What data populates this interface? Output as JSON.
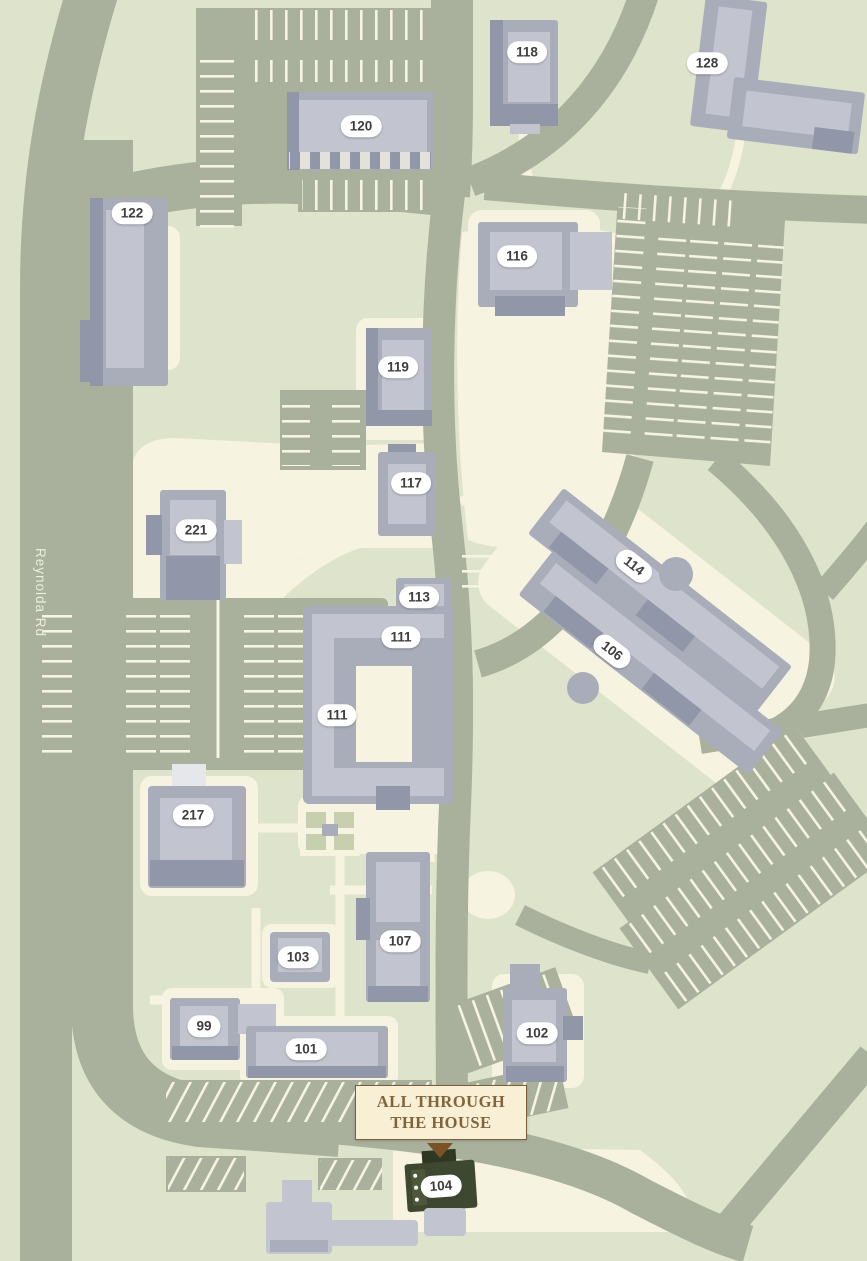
{
  "map": {
    "road_label": "Reynolda Rd",
    "callout": {
      "line1": "ALL THROUGH",
      "line2": "THE HOUSE"
    },
    "highlighted_building": "104",
    "buildings": {
      "b118": "118",
      "b128": "128",
      "b120": "120",
      "b122": "122",
      "b116": "116",
      "b119": "119",
      "b117": "117",
      "b221": "221",
      "b114": "114",
      "b113": "113",
      "b111_north": "111",
      "b106": "106",
      "b111_south": "111",
      "b217": "217",
      "b103": "103",
      "b107": "107",
      "b99": "99",
      "b101": "101",
      "b102": "102",
      "b104": "104"
    },
    "colors": {
      "bg": "#dee4cc",
      "road": "#a9b19d",
      "path": "#f6f3e0",
      "stripe": "#f6f4e2",
      "building": "#a9adba",
      "building_light": "#c2c5d0",
      "building_dark": "#9197a8",
      "highlight": "#3e4730",
      "highlight_light": "#4e5838",
      "highlight_dark": "#2f3722",
      "pill_bg": "#ffffff",
      "pill_text": "#3e3e3e",
      "callout_bg": "#f8efd5",
      "callout_border": "#7c5e3c",
      "callout_text": "#82643c",
      "arrow": "#7b5226",
      "road_text": "#ebeede",
      "garden": "#c8cfae"
    }
  }
}
